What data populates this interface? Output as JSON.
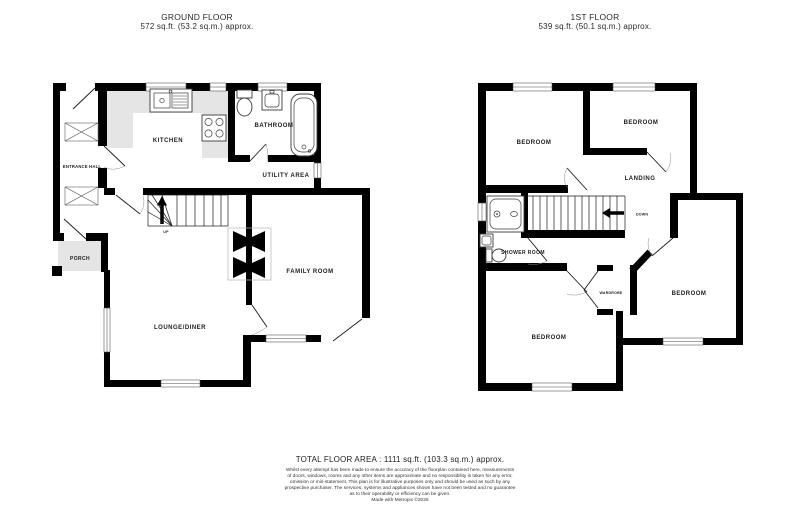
{
  "ground_floor": {
    "title": "GROUND FLOOR",
    "area_label": "572 sq.ft. (53.2 sq.m.) approx.",
    "rooms": {
      "entrance_hall": "ENTRANCE HALL",
      "porch": "PORCH",
      "kitchen": "KITCHEN",
      "bathroom": "BATHROOM",
      "utility_area": "UTILITY AREA",
      "family_room": "FAMILY ROOM",
      "lounge_diner": "LOUNGE/DINER",
      "stair_direction": "UP"
    }
  },
  "first_floor": {
    "title": "1ST FLOOR",
    "area_label": "539 sq.ft. (50.1 sq.m.) approx.",
    "rooms": {
      "bedroom_front_left": "BEDROOM",
      "bedroom_front_right": "BEDROOM",
      "landing": "LANDING",
      "shower_room": "SHOWER ROOM",
      "wardrobe": "WARDROBE",
      "bedroom_right": "BEDROOM",
      "bedroom_back_left": "BEDROOM",
      "stair_direction": "DOWN"
    }
  },
  "footer": {
    "total_area": "TOTAL FLOOR AREA : 1111 sq.ft. (103.3 sq.m.) approx.",
    "disclaimer_lines": [
      "Whilst every attempt has been made to ensure the accuracy of the floorplan contained here, measurements",
      "of doors, windows, rooms and any other items are approximate and no responsibility is taken for any error,",
      "omission or mis-statement. This plan is for illustrative purposes only and should be used as such by any",
      "prospective purchaser. The services, systems and appliances shown have not been tested and no guarantee",
      "as to their operability or efficiency can be given."
    ],
    "credit": "Made with Metropix ©2026"
  },
  "colors": {
    "wall": "#000000",
    "counter": "#e5e5e5",
    "text": "#1c1c1c"
  }
}
